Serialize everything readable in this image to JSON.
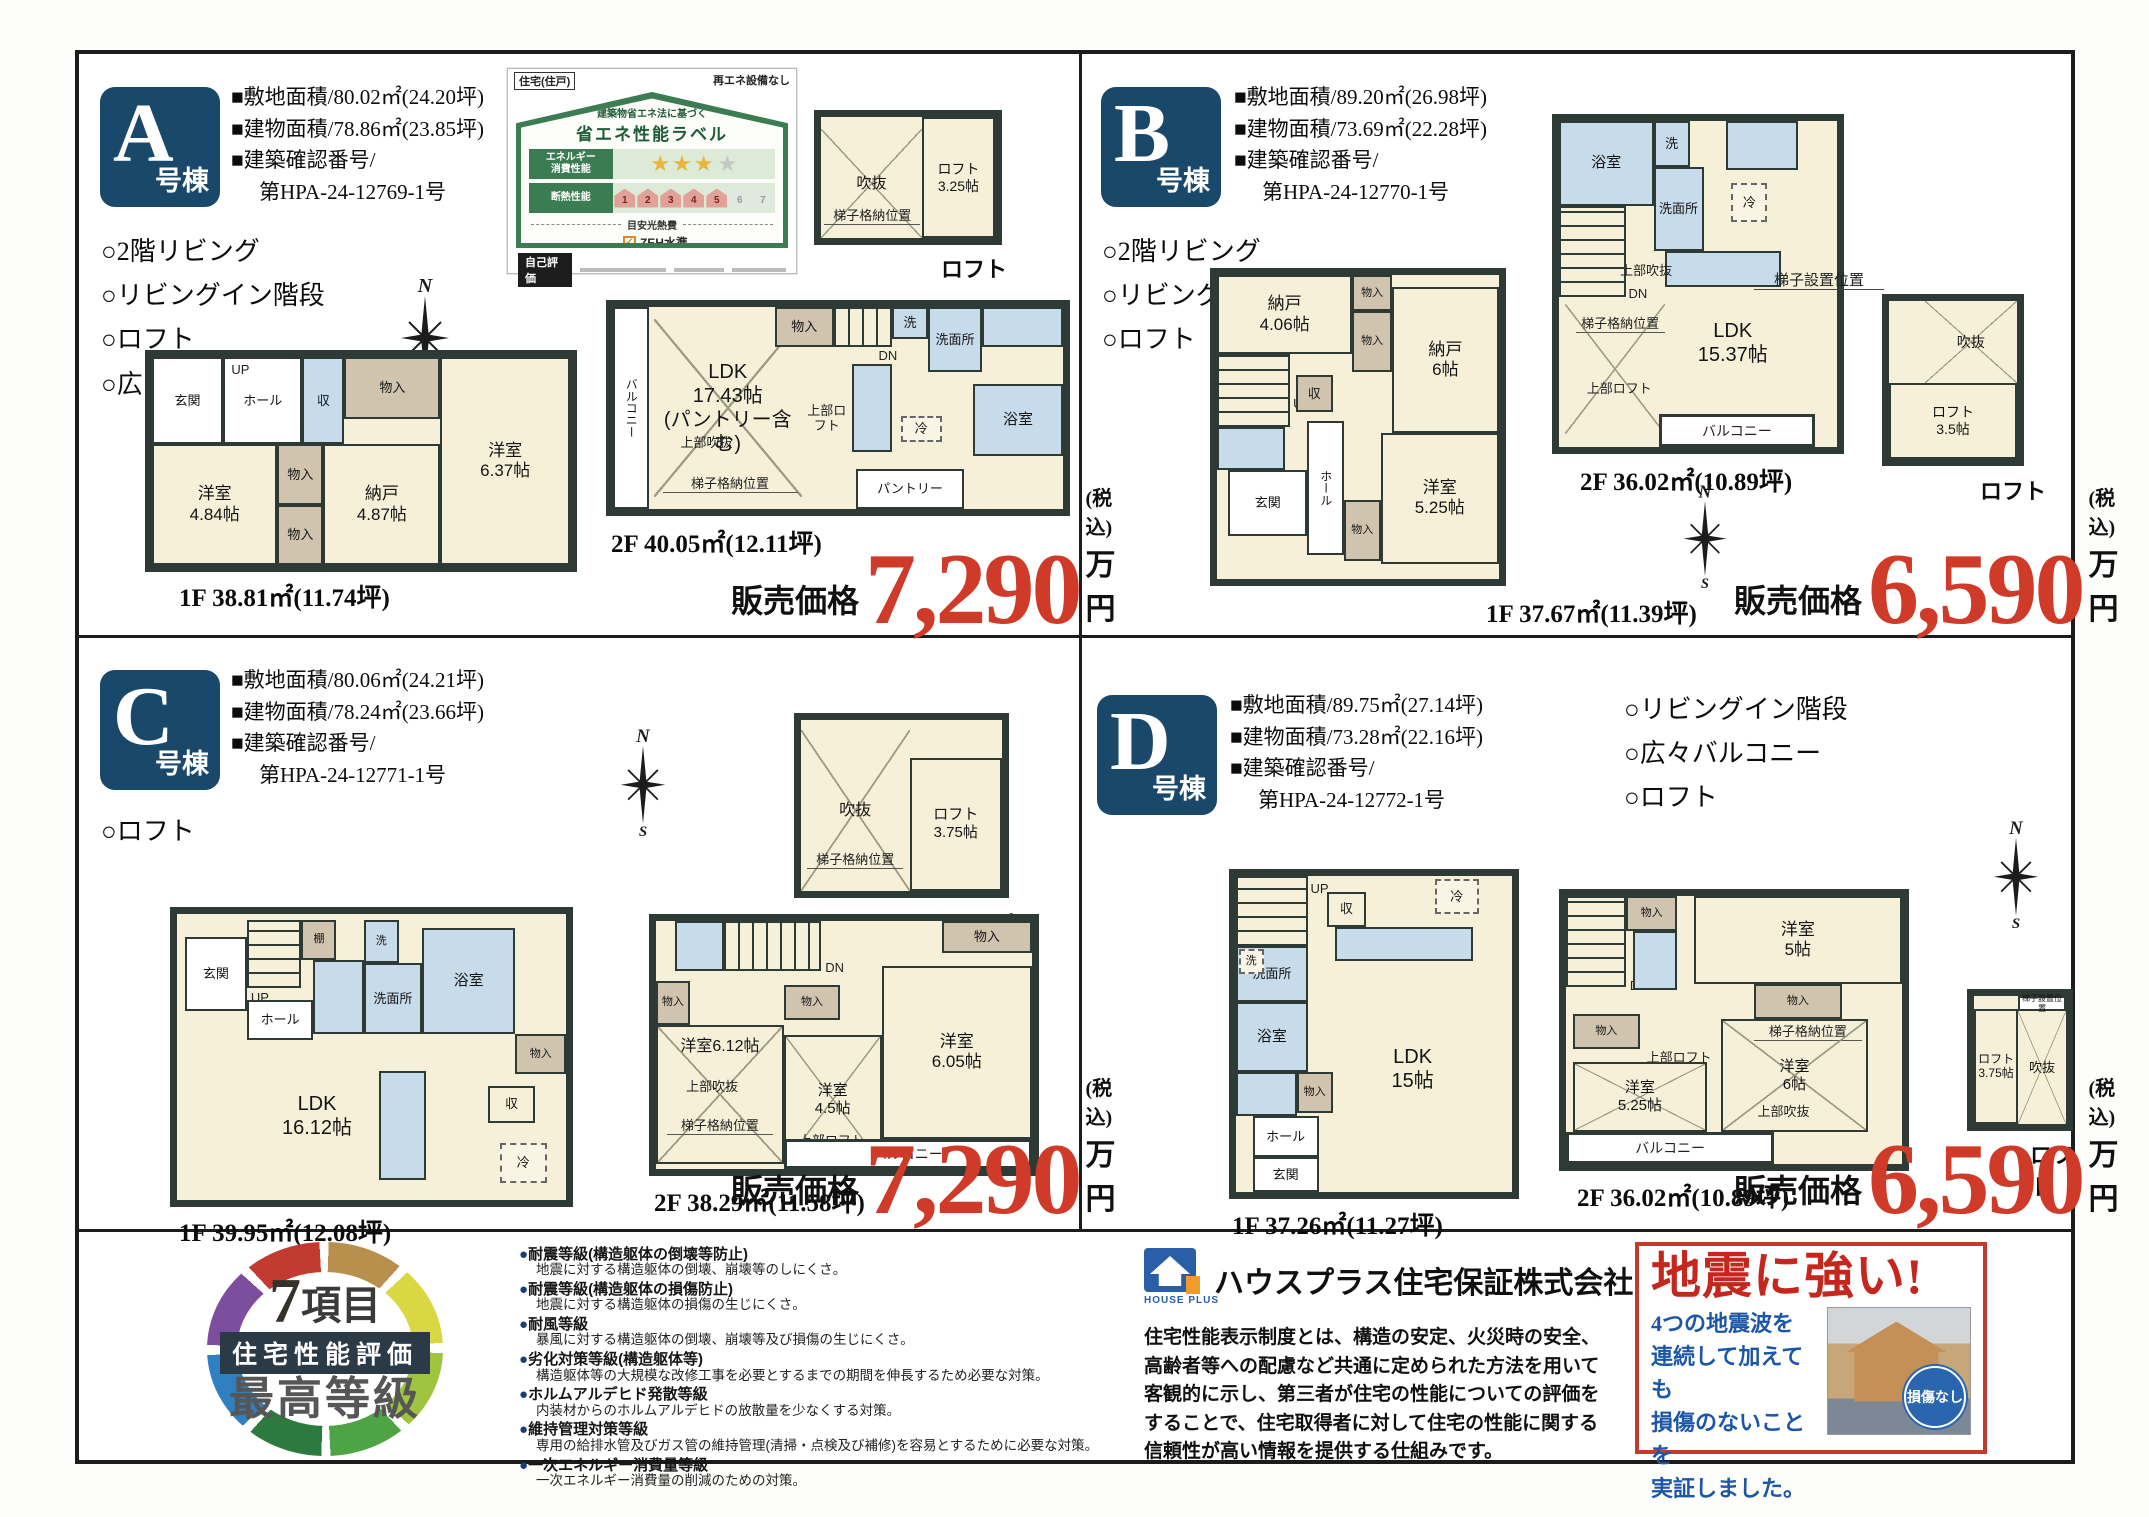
{
  "common": {
    "price_label": "販売価格",
    "tax": "(税込)",
    "unit": "万円",
    "loft": "ロフト"
  },
  "compass": {
    "n": "N",
    "s": "S"
  },
  "rooms": {
    "mono": "物入",
    "shu": "収",
    "tana": "棚",
    "fridge": "冷",
    "wash": "洗",
    "senmen": "洗面所",
    "bath": "浴室",
    "genkan": "玄関",
    "hall": "ホール",
    "up": "UP",
    "dn": "DN",
    "balcony": "バルコニー",
    "pantry": "パントリー",
    "voidup": "上部吹抜",
    "loftup": "上部ロフト",
    "ladder_store": "梯子格納位置",
    "ladder_set": "梯子設置位置",
    "void": "吹抜"
  },
  "a": {
    "letter": "A",
    "suffix": "号棟",
    "specs": [
      "■敷地面積/80.02㎡(24.20坪)",
      "■建物面積/78.86㎡(23.85坪)",
      "■建築確認番号/",
      "第HPA-24-12769-1号"
    ],
    "features": [
      "○2階リビング",
      "○リビングイン階段",
      "○ロフト",
      "○広々バルコニー"
    ],
    "price": "7,290",
    "f1_caption": "1F 38.81㎡(11.74坪)",
    "f2_caption": "2F 40.05㎡(12.11坪)",
    "yo484": "洋室\n4.84帖",
    "nando487": "納戸\n4.87帖",
    "yo637": "洋室\n6.37帖",
    "ldk": "LDK\n17.43帖\n(パントリー含む)",
    "loft325": "ロフト\n3.25帖"
  },
  "b": {
    "letter": "B",
    "suffix": "号棟",
    "specs": [
      "■敷地面積/89.20㎡(26.98坪)",
      "■建物面積/73.69㎡(22.28坪)",
      "■建築確認番号/",
      "第HPA-24-12770-1号"
    ],
    "features": [
      "○2階リビング",
      "○リビングイン階段",
      "○ロフト"
    ],
    "price": "6,590",
    "f1_caption": "1F 37.67㎡(11.39坪)",
    "f2_caption": "2F 36.02㎡(10.89坪)",
    "nando406": "納戸\n4.06帖",
    "nando6": "納戸\n6帖",
    "yo525": "洋室\n5.25帖",
    "ldk": "LDK\n15.37帖",
    "loft35": "ロフト\n3.5帖"
  },
  "c": {
    "letter": "C",
    "suffix": "号棟",
    "specs": [
      "■敷地面積/80.06㎡(24.21坪)",
      "■建物面積/78.24㎡(23.66坪)",
      "■建築確認番号/",
      "第HPA-24-12771-1号"
    ],
    "features": [
      "○ロフト"
    ],
    "price": "7,290",
    "f1_caption": "1F 39.95㎡(12.08坪)",
    "f2_caption": "2F 38.29㎡(11.58坪)",
    "ldk": "LDK\n16.12帖",
    "yo612": "洋室6.12帖",
    "yo45": "洋室\n4.5帖",
    "yo605": "洋室\n6.05帖",
    "loft375": "ロフト\n3.75帖"
  },
  "d": {
    "letter": "D",
    "suffix": "号棟",
    "specs": [
      "■敷地面積/89.75㎡(27.14坪)",
      "■建物面積/73.28㎡(22.16坪)",
      "■建築確認番号/",
      "第HPA-24-12772-1号"
    ],
    "features": [
      "○リビングイン階段",
      "○広々バルコニー",
      "○ロフト"
    ],
    "price": "6,590",
    "f1_caption": "1F 37.26㎡(11.27坪)",
    "f2_caption": "2F 36.02㎡(10.89坪)",
    "ldk": "LDK\n15帖",
    "yo5": "洋室\n5帖",
    "yo525": "洋室\n5.25帖",
    "yo6": "洋室\n6帖",
    "loft375": "ロフト\n3.75帖"
  },
  "energy": {
    "top_left": "住宅(住戸)",
    "top_right": "再エネ設備なし",
    "subtitle": "建築物省エネ法に基づく",
    "title": "省エネ性能ラベル",
    "row1": "エネルギー\n消費性能",
    "row2": "断熱性能",
    "stars_gold": "★★★",
    "stars_gray": "★",
    "levels": [
      "1",
      "2",
      "3",
      "4",
      "5",
      "6",
      "7"
    ],
    "cost_label": "目安光熱費",
    "cost_value": "なし",
    "check": "✓",
    "zeh": "ZEH水準",
    "zeh_note": "エネルギー消費性能で★3つ(太陽光発電\nは考慮しない)、かつ断熱性能で5を達成",
    "self_eval": "自己評価"
  },
  "bottom": {
    "ring": {
      "num": "7",
      "unit": "項目",
      "band": "住宅性能評価",
      "grade": "最高等級"
    },
    "grades": [
      {
        "t": "●耐震等級(構造躯体の倒壊等防止)",
        "d": "地震に対する構造躯体の倒壊、崩壊等のしにくさ。"
      },
      {
        "t": "●耐震等級(構造躯体の損傷防止)",
        "d": "地震に対する構造躯体の損傷の生じにくさ。"
      },
      {
        "t": "●耐風等級",
        "d": "暴風に対する構造躯体の倒壊、崩壊等及び損傷の生じにくさ。"
      },
      {
        "t": "●劣化対策等級(構造躯体等)",
        "d": "構造躯体等の大規模な改修工事を必要とするまでの期間を伸長するため必要な対策。"
      },
      {
        "t": "●ホルムアルデヒド発散等級",
        "d": "内装材からのホルムアルデヒドの放散量を少なくする対策。"
      },
      {
        "t": "●維持管理対策等級",
        "d": "専用の給排水管及びガス管の維持管理(清掃・点検及び補修)を容易とするために必要な対策。"
      },
      {
        "t": "●一次エネルギー消費量等級",
        "d": "一次エネルギー消費量の削減のための対策。"
      }
    ],
    "houseplus": {
      "logo": "HOUSE PLUS",
      "company": "ハウスプラス住宅保証株式会社",
      "body": "住宅性能表示制度とは、構造の安定、火災時の安全、\n高齢者等への配慮など共通に定められた方法を用いて\n客観的に示し、第三者が住宅の性能についての評価を\nすることで、住宅取得者に対して住宅の性能に関する\n信頼性が高い情報を提供する仕組みです。"
    },
    "quake": {
      "title": "地震に強い!",
      "body": "4つの地震波を\n連続して加えても\n損傷のないことを\n実証しました。",
      "badge": "損傷なし"
    }
  }
}
